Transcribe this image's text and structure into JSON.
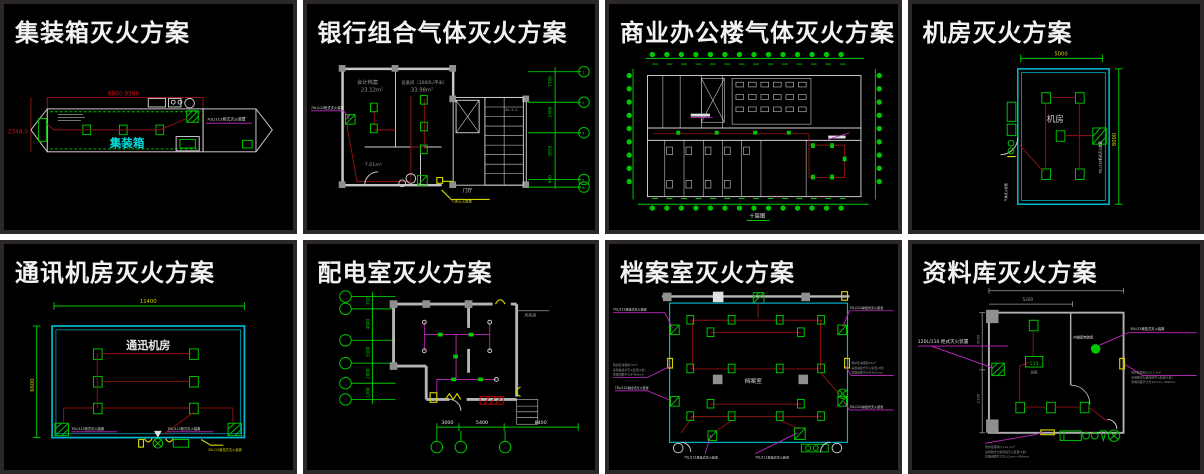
{
  "panels": {
    "container": {
      "title": "集装箱灭火方案",
      "room": "集装箱",
      "dim_top": "8860.9386",
      "dim_left": "2348.0",
      "device": "70L/112柜式灭火装置"
    },
    "bank": {
      "title": "银行组合气体灭火方案",
      "room1": "会计档案",
      "room1_area": "23.12m²",
      "room2": "设备间（3000L/平米）",
      "room2_area": "33.98m²",
      "room3_area": "7.01m²",
      "stair": "BL-5-1",
      "lobby": "门厅",
      "device": "70L/112柜式灭火装置",
      "note": "气体灭火装置",
      "axis_dims": [
        "7300",
        "2400",
        "3850",
        "600"
      ],
      "axis_ids": [
        "1",
        "2",
        "4",
        "5",
        "6"
      ]
    },
    "office": {
      "title": "商业办公楼气体灭火方案",
      "caption": "十层图"
    },
    "machine": {
      "title": "机房灭火方案",
      "room": "机房",
      "dim_top": "5000",
      "dim_right": "8000",
      "device": "70L/112柜式灭火装置",
      "note": "气体灭火装置"
    },
    "telecom": {
      "title": "通讯机房灭火方案",
      "room": "通迅机房",
      "dim_top": "11400",
      "dim_left": "6600",
      "device_left": "70L/112柜式灭火装置",
      "device_right": "70L/112柜式灭火装置",
      "note": "30L/13悬挂式灭火装置"
    },
    "power": {
      "title": "配电室灭火方案",
      "fan_room": "风机房",
      "dims_left": [
        "310",
        "4600",
        "3100",
        "2000",
        "2200"
      ],
      "dims_bottom": [
        "3000",
        "5400",
        "8400"
      ]
    },
    "archive": {
      "title": "档案室灭火方案",
      "room": "档案室",
      "dev": "70L/112悬挂式灭火装置",
      "note1": "防护区净容积72m³",
      "note2": "采用悬挂式灭火装置(2套)",
      "note3": "喷嘴间距不大于400mm"
    },
    "library": {
      "title": "资料库灭火方案",
      "dim_top": "5200",
      "dim_left1": "3000",
      "dim_left2": "2100",
      "device_left": "120L/110 柜式灭火装置",
      "device_right": "30L/13悬挂式灭火装置",
      "circle_label": "内部配电装置",
      "valve": "115",
      "valve_sub": "阀组",
      "note1": "防护区容积(V):12.1m³",
      "note2": "采用柜式七氟丙烷灭火装置(1套)",
      "note3": "喷嘴间距尺寸为1/2mm~400mm"
    }
  }
}
